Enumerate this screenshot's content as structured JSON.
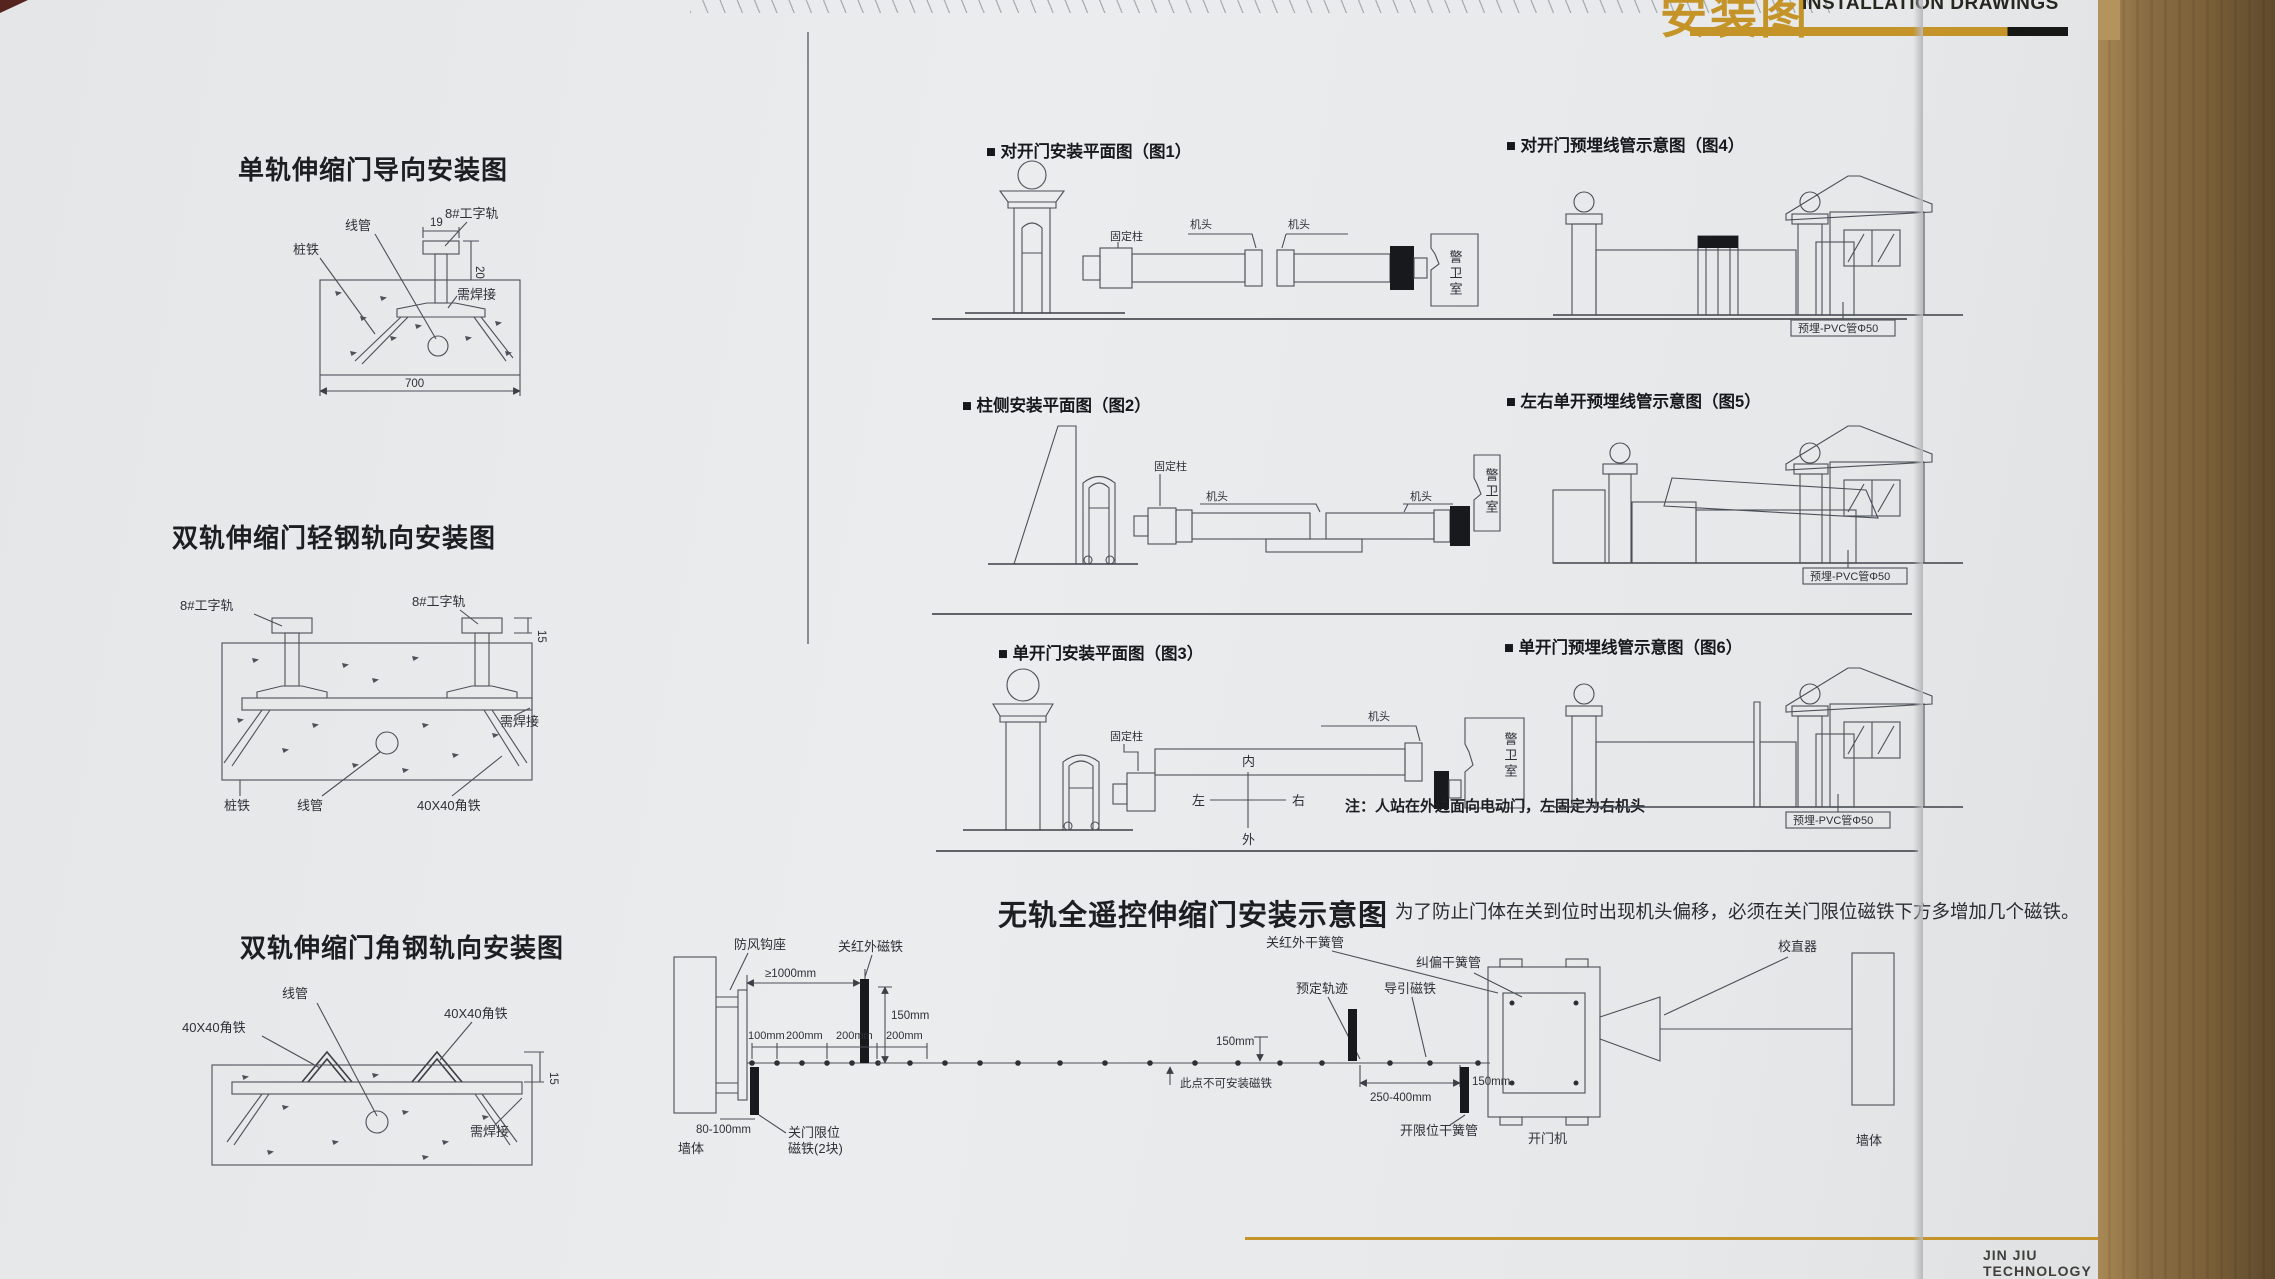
{
  "header": {
    "title_cn": "安装图",
    "title_en": "INSTALLATION DRAWINGS"
  },
  "footer": {
    "brand": "JIN JIU TECHNOLOGY",
    "page_no": "082"
  },
  "shared": {
    "head": "机头",
    "guard": "警卫室",
    "post": "固定柱",
    "wall": "墙体",
    "pvc": "预埋-PVC管Φ50",
    "rail8": "8#工字轨",
    "angle40": "40X40角铁",
    "weld": "需焊接",
    "conduit": "线管",
    "pile": "桩铁",
    "d150": "150mm",
    "d200": "200mm"
  },
  "left": {
    "d1": {
      "title": "单轨伸缩门导向安装图",
      "dims": {
        "w19": "19",
        "h20": "20",
        "w700": "700"
      }
    },
    "d2": {
      "title": "双轨伸缩门轻钢轨向安装图",
      "dims": {
        "h15": "15"
      }
    },
    "d3": {
      "title": "双轨伸缩门角钢轨向安装图",
      "dims": {
        "h15": "15"
      }
    }
  },
  "plans": {
    "fig1": {
      "caption": "■ 对开门安装平面图（图1）"
    },
    "fig2": {
      "caption": "■ 柱侧安装平面图（图2）"
    },
    "fig3": {
      "caption": "■ 单开门安装平面图（图3）",
      "compass": {
        "n": "内",
        "s": "外",
        "w": "左",
        "e": "右"
      },
      "note": "注：人站在外边面向电动门，左固定为右机头"
    },
    "fig4": {
      "caption": "■ 对开门预埋线管示意图（图4）"
    },
    "fig5": {
      "caption": "■ 左右单开预埋线管示意图（图5）"
    },
    "fig6": {
      "caption": "■ 单开门预埋线管示意图（图6）"
    }
  },
  "trackless": {
    "title": "无轨全遥控伸缩门安装示意图",
    "note": "为了防止门体在关到位时出现机头偏移，必须在关门限位磁铁下方多增加几个磁铁。",
    "labels": {
      "windproof": "防风钩座",
      "ir_close_magnet": "关红外磁铁",
      "ir_close_reed": "关红外干簧管",
      "straightener": "校直器",
      "ge1000": "≥1000mm",
      "d100": "100mm",
      "track": "预定轨迹",
      "guide_magnet": "导引磁铁",
      "rectify_reed": "纠偏干簧管",
      "no_magnet": "此点不可安装磁铁",
      "d250_400": "250-400mm",
      "d80_100": "80-100mm",
      "close_limit_1": "关门限位",
      "close_limit_2": "磁铁(2块)",
      "open_limit_reed": "开限位干簧管",
      "opener": "开门机"
    }
  }
}
